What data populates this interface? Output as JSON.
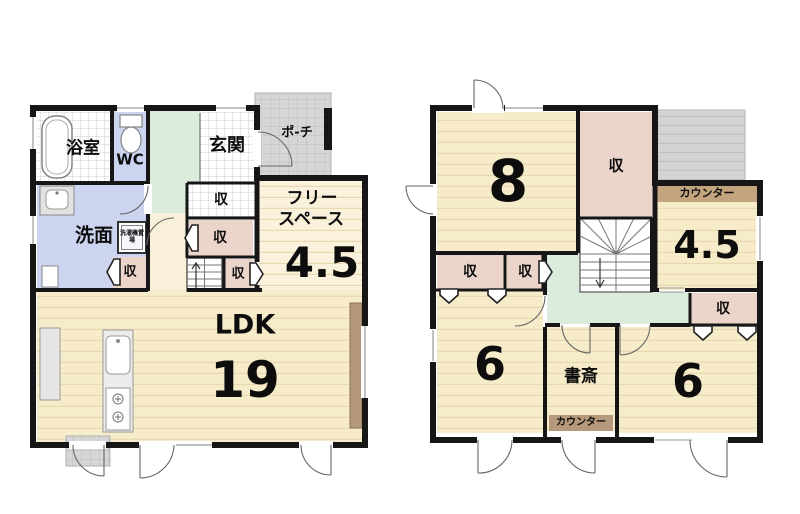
{
  "floor1": {
    "bath": "浴室",
    "wc": "WC",
    "entrance": "玄関",
    "porch": "ポ-チ",
    "washroom": "洗面",
    "laundry": "洗濯機置場",
    "storage": "収",
    "free_space_line1": "フリー",
    "free_space_line2": "スペース",
    "free_space_size": "4.5",
    "ldk": "LDK",
    "ldk_size": "19"
  },
  "floor2": {
    "storage": "収",
    "counter": "カウンター",
    "room8_size": "8",
    "room45_size": "4.5",
    "room6_left_size": "6",
    "room6_right_size": "6",
    "study": "書斎"
  },
  "colors": {
    "wall": "#161616",
    "tatami_cream": "#f7ecca",
    "free_space_cream": "#faf2dc",
    "storage_pink": "#ebd4ca",
    "water_blue": "#ccd4f0",
    "hall_green": "#dcecdc",
    "tile_gray": "#d6d6d6",
    "counter_tan": "#b89a78"
  }
}
